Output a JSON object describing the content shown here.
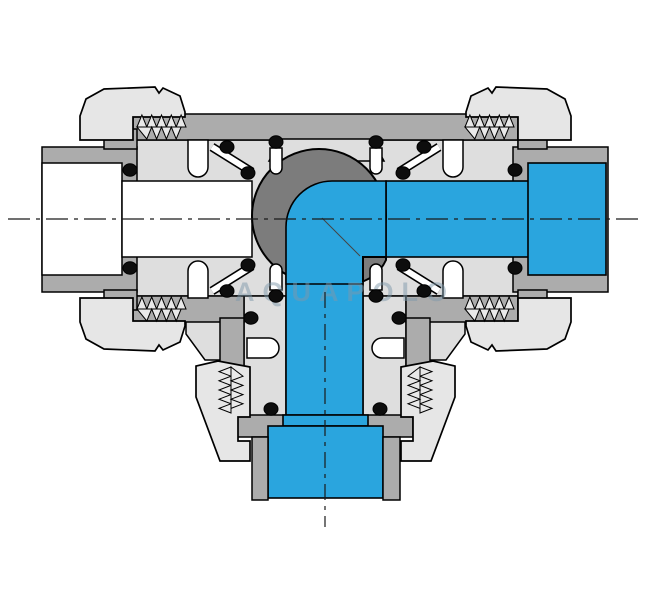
{
  "figure": {
    "type": "technical-cross-section-diagram",
    "subject": "3-way ball valve sectional drawing, L-port ball, flow entering right port and exiting bottom port",
    "watermark": "AQUAPOLO"
  },
  "colors": {
    "body_light": "#dedede",
    "nut_light": "#e6e6e6",
    "wall_mid": "#acacac",
    "ball_gray": "#7c7c7c",
    "fluid_blue": "#2aa5de",
    "seal_black": "#0d0d0d",
    "thread_light": "#e9e9e9",
    "centerline": "#1a1a1a",
    "watermark_color": "rgba(125,152,170,0.5)",
    "background": "#ffffff"
  }
}
